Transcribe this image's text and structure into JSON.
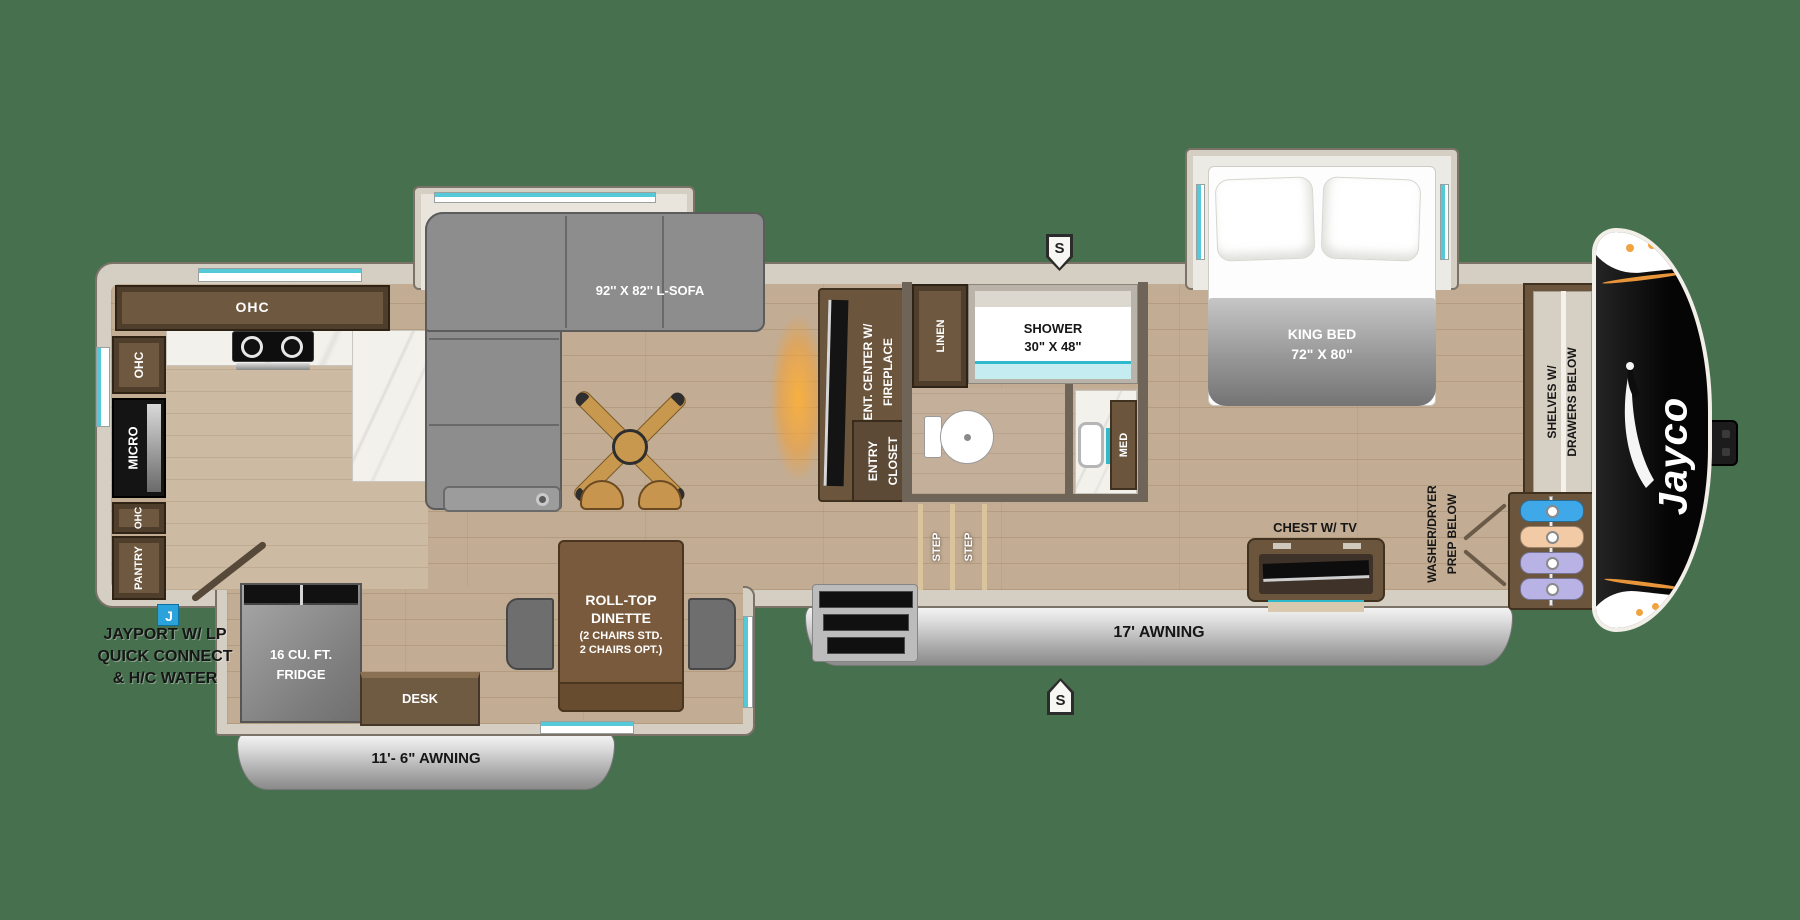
{
  "background": "#47704F",
  "brand": {
    "logo_text": "Jayco"
  },
  "colors": {
    "background_green": "#47704F",
    "wall_tan": "#d5cec3",
    "cabinet_brown": "#6b553d",
    "floor_wood": "#c2ac93",
    "accent_teal": "#56c9d8",
    "awning_silver": "#c9c9c9",
    "front_cap_black": "#0d0d0d",
    "jayport_blue": "#2aa3dc",
    "fireplace_glow": "#f0a040",
    "hanger_blue": "#3fa8e8",
    "hanger_peach": "#f2cba6",
    "hanger_lavender": "#b9b2e4"
  },
  "labels": {
    "kitchen": {
      "ohc_top": "OHC",
      "ohc_upper": "OHC",
      "micro": "MICRO",
      "ohc_lower": "OHC",
      "pantry": "PANTRY"
    },
    "fridge": {
      "line1": "16 CU. FT.",
      "line2": "FRIDGE"
    },
    "desk": "DESK",
    "dinette": {
      "line1": "ROLL-TOP",
      "line2": "DINETTE",
      "line3": "(2 CHAIRS STD.",
      "line4": "2 CHAIRS OPT.)"
    },
    "sofa": "92'' X 82'' L-SOFA",
    "ent_center": {
      "line1": "ENT. CENTER W/",
      "line2": "FIREPLACE"
    },
    "entry_closet": {
      "line1": "ENTRY",
      "line2": "CLOSET"
    },
    "steps": {
      "step_left": "STEP",
      "step_right": "STEP"
    },
    "bath": {
      "linen": "LINEN",
      "shower_line1": "SHOWER",
      "shower_line2": "30\" X 48\"",
      "med": "MED"
    },
    "bedroom": {
      "king_line1": "KING BED",
      "king_line2": "72\" X 80\"",
      "chest": "CHEST W/ TV",
      "shelves_line1": "SHELVES W/",
      "shelves_line2": "DRAWERS BELOW",
      "washer_line1": "WASHER/DRYER",
      "washer_line2": "PREP BELOW"
    },
    "awnings": {
      "small": "11'- 6\" AWNING",
      "large": "17' AWNING"
    },
    "jayport": {
      "badge": "J",
      "line1": "JAYPORT W/ LP",
      "line2": "QUICK CONNECT",
      "line3": "& H/C WATER"
    },
    "markers": {
      "speaker_top": "S",
      "speaker_bottom": "S"
    }
  }
}
